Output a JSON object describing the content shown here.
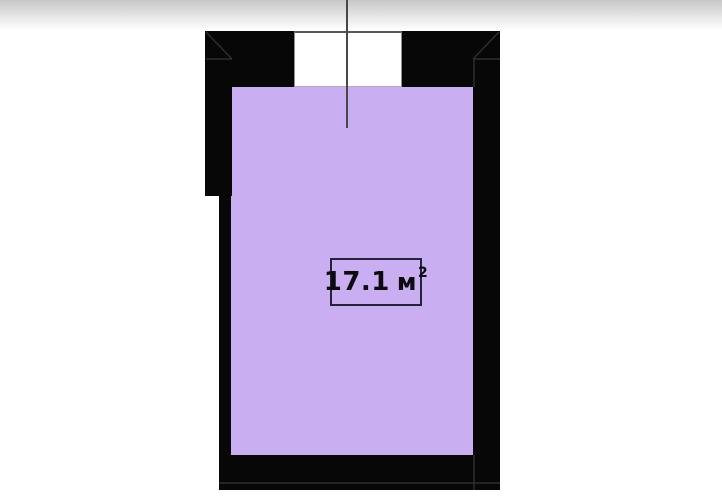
{
  "plan": {
    "room": {
      "area_value": "17.1",
      "area_unit": "м",
      "area_superscript": "2"
    }
  },
  "colors": {
    "background": "#ffffff",
    "wall": "#070707",
    "wall_detail_line": "#2e2e2e",
    "room_fill": "#c9aef2",
    "window_fill": "#ffffff",
    "centerline": "#474747",
    "label_border": "#23233a",
    "label_text": "#0b0b10",
    "top_shadow": "#c7c7c7"
  }
}
